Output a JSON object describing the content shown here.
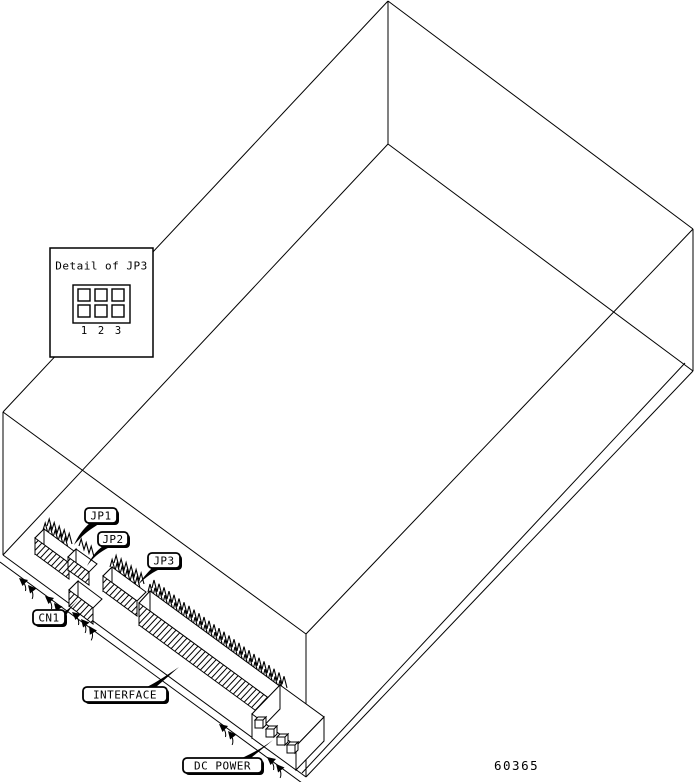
{
  "diagram": {
    "description": "Isometric wireframe line drawing of a disk drive enclosure showing PCB edge connectors",
    "colors": {
      "line": "#000000",
      "background": "#ffffff"
    },
    "detail_box": {
      "title": "Detail of JP3",
      "pin_labels": [
        "1",
        "2",
        "3"
      ]
    },
    "callouts": {
      "jp1": "JP1",
      "jp2": "JP2",
      "jp3": "JP3",
      "cn1": "CN1",
      "interface": "INTERFACE",
      "dc_power": "DC POWER"
    },
    "part_number": "60365"
  }
}
